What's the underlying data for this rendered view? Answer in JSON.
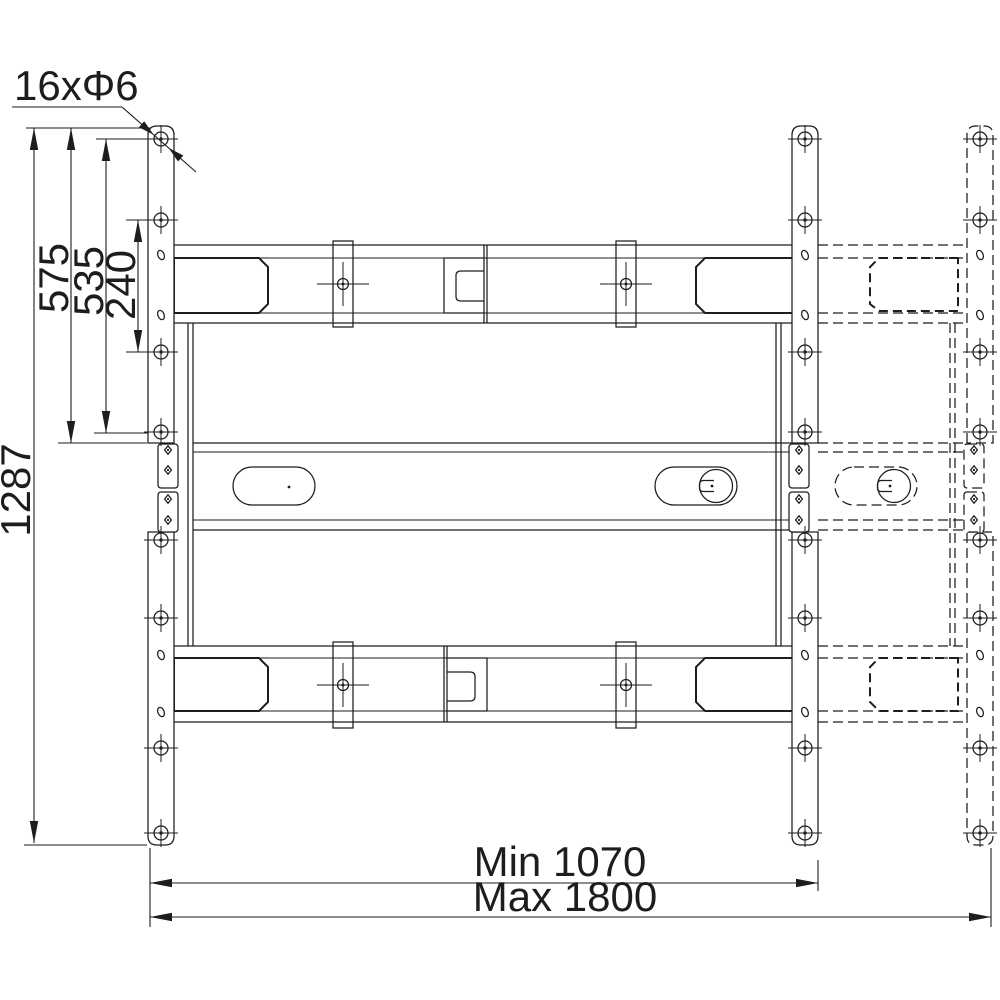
{
  "labels": {
    "hole_callout": "16xΦ6",
    "dim_total_height": "1287",
    "dim_575": "575",
    "dim_535": "535",
    "dim_240": "240",
    "dim_min_width": "Min 1070",
    "dim_max_width": "Max 1800"
  },
  "colors": {
    "line": "#1d1d1f",
    "background": "#ffffff"
  }
}
